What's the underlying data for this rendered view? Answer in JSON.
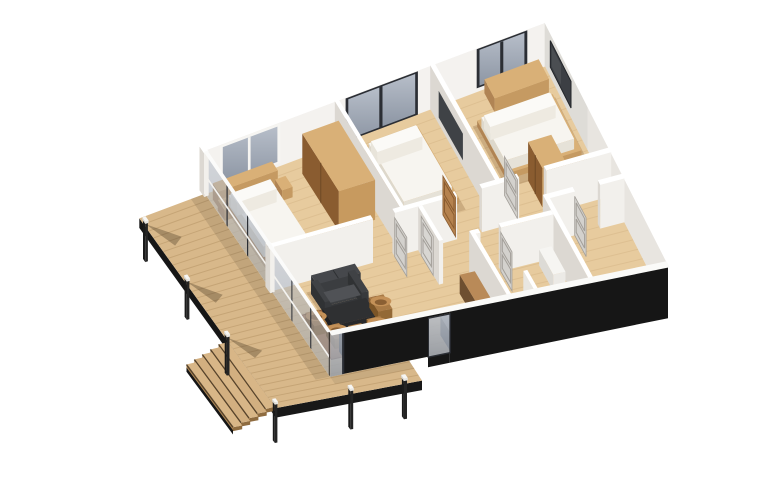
{
  "scene": {
    "type": "3d-isometric-floor-plan-render",
    "view": "aerial axonometric cutaway, roof removed (dollhouse view)",
    "background": "#ffffff"
  },
  "palette": {
    "background": "#ffffff",
    "deck_wood": "#d8b88a",
    "deck_plank_line": "#b08e5e",
    "floor_wood": "#e7cb9e",
    "floor_line": "#c9a878",
    "wall_top": "#ffffff",
    "wall_face_light": "#f2f0ec",
    "wall_face_shadow": "#dcd8d2",
    "wall_exterior_black": "#161616",
    "glass_top": "#b7bec9",
    "glass_bottom": "#8d96a4",
    "frame_dark": "#2b2e34",
    "frame_white": "#f6f5f2",
    "bed_linen": "#f7f5f0",
    "bed_linen_shade": "#e6e2d8",
    "wood_furniture": "#d9b077",
    "wood_furniture_side": "#c59a62",
    "wood_furniture_dark": "#b08454",
    "wood_interior": "#8a5c30",
    "sofa_dark": "#3d3f42",
    "sofa_cushion": "#505256",
    "table_dark": "#2f3032",
    "chair_rattan": "#c49158",
    "chair_rattan_dark": "#7c5527",
    "rug_brown": "#a8754e",
    "counter_gray_top": "#9e9d9b",
    "counter_wood_top": "#b98a58",
    "door_leaf": "#d3d1cd",
    "door_leaf_line": "#a39f99",
    "door_leaf_brown": "#b5824e",
    "stove_black": "#232425",
    "post_black": "#1a1a1a",
    "post_cap": "#f6f6f4",
    "tub_white": "#f7f7f5",
    "art_dark": "#3c3f44",
    "shadow_soft": "rgba(120,80,40,0.25)",
    "shadow_post": "rgba(60,45,25,0.32)"
  },
  "exterior": {
    "facade_finish": "black cladding on the front elevation",
    "deck": "timber deck wrapping the west and south-west sides, raised on stilts",
    "stairs": "five timber steps descending from the deck corner",
    "posts": "slender black stilt posts with white caps",
    "glazing": "floor-to-ceiling glass wall with dark mullions between deck and interior"
  },
  "rooms": [
    {
      "id": "master-bedroom",
      "label": "Master bedroom",
      "furniture": [
        "double bed with white duvet",
        "timber headboard shelf",
        "two nightstands",
        "tall open wardrobe",
        "white-framed picture window"
      ]
    },
    {
      "id": "bedroom-2",
      "label": "Bedroom 2",
      "furniture": [
        "double bed with white duvet",
        "full-height dark-framed glazing",
        "dark wall mirror"
      ]
    },
    {
      "id": "bedroom-3",
      "label": "Bedroom 3",
      "furniture": [
        "double bed with white duvet",
        "timber desk along window wall",
        "dark wall art",
        "corner wardrobe",
        "dark-framed window"
      ]
    },
    {
      "id": "hallway",
      "label": "Hallway",
      "furniture": [
        "light gray panel doors, several standing open"
      ]
    },
    {
      "id": "bathroom",
      "label": "Bathroom",
      "furniture": [
        "walk-in shower behind white half wall",
        "white vanity unit"
      ]
    },
    {
      "id": "wc-bathroom",
      "label": "Second bathroom",
      "furniture": [
        "white bathtub along the front wall"
      ]
    },
    {
      "id": "living-dining-kitchen",
      "label": "Living / dining / kitchen",
      "furniture": [
        "dark gray sofa",
        "dark rectangular table",
        "five rattan barrel chairs",
        "brown area rug",
        "black wood stove",
        "L-shaped kitchen counter with gray stone top",
        "glass entry door in black façade"
      ]
    }
  ]
}
